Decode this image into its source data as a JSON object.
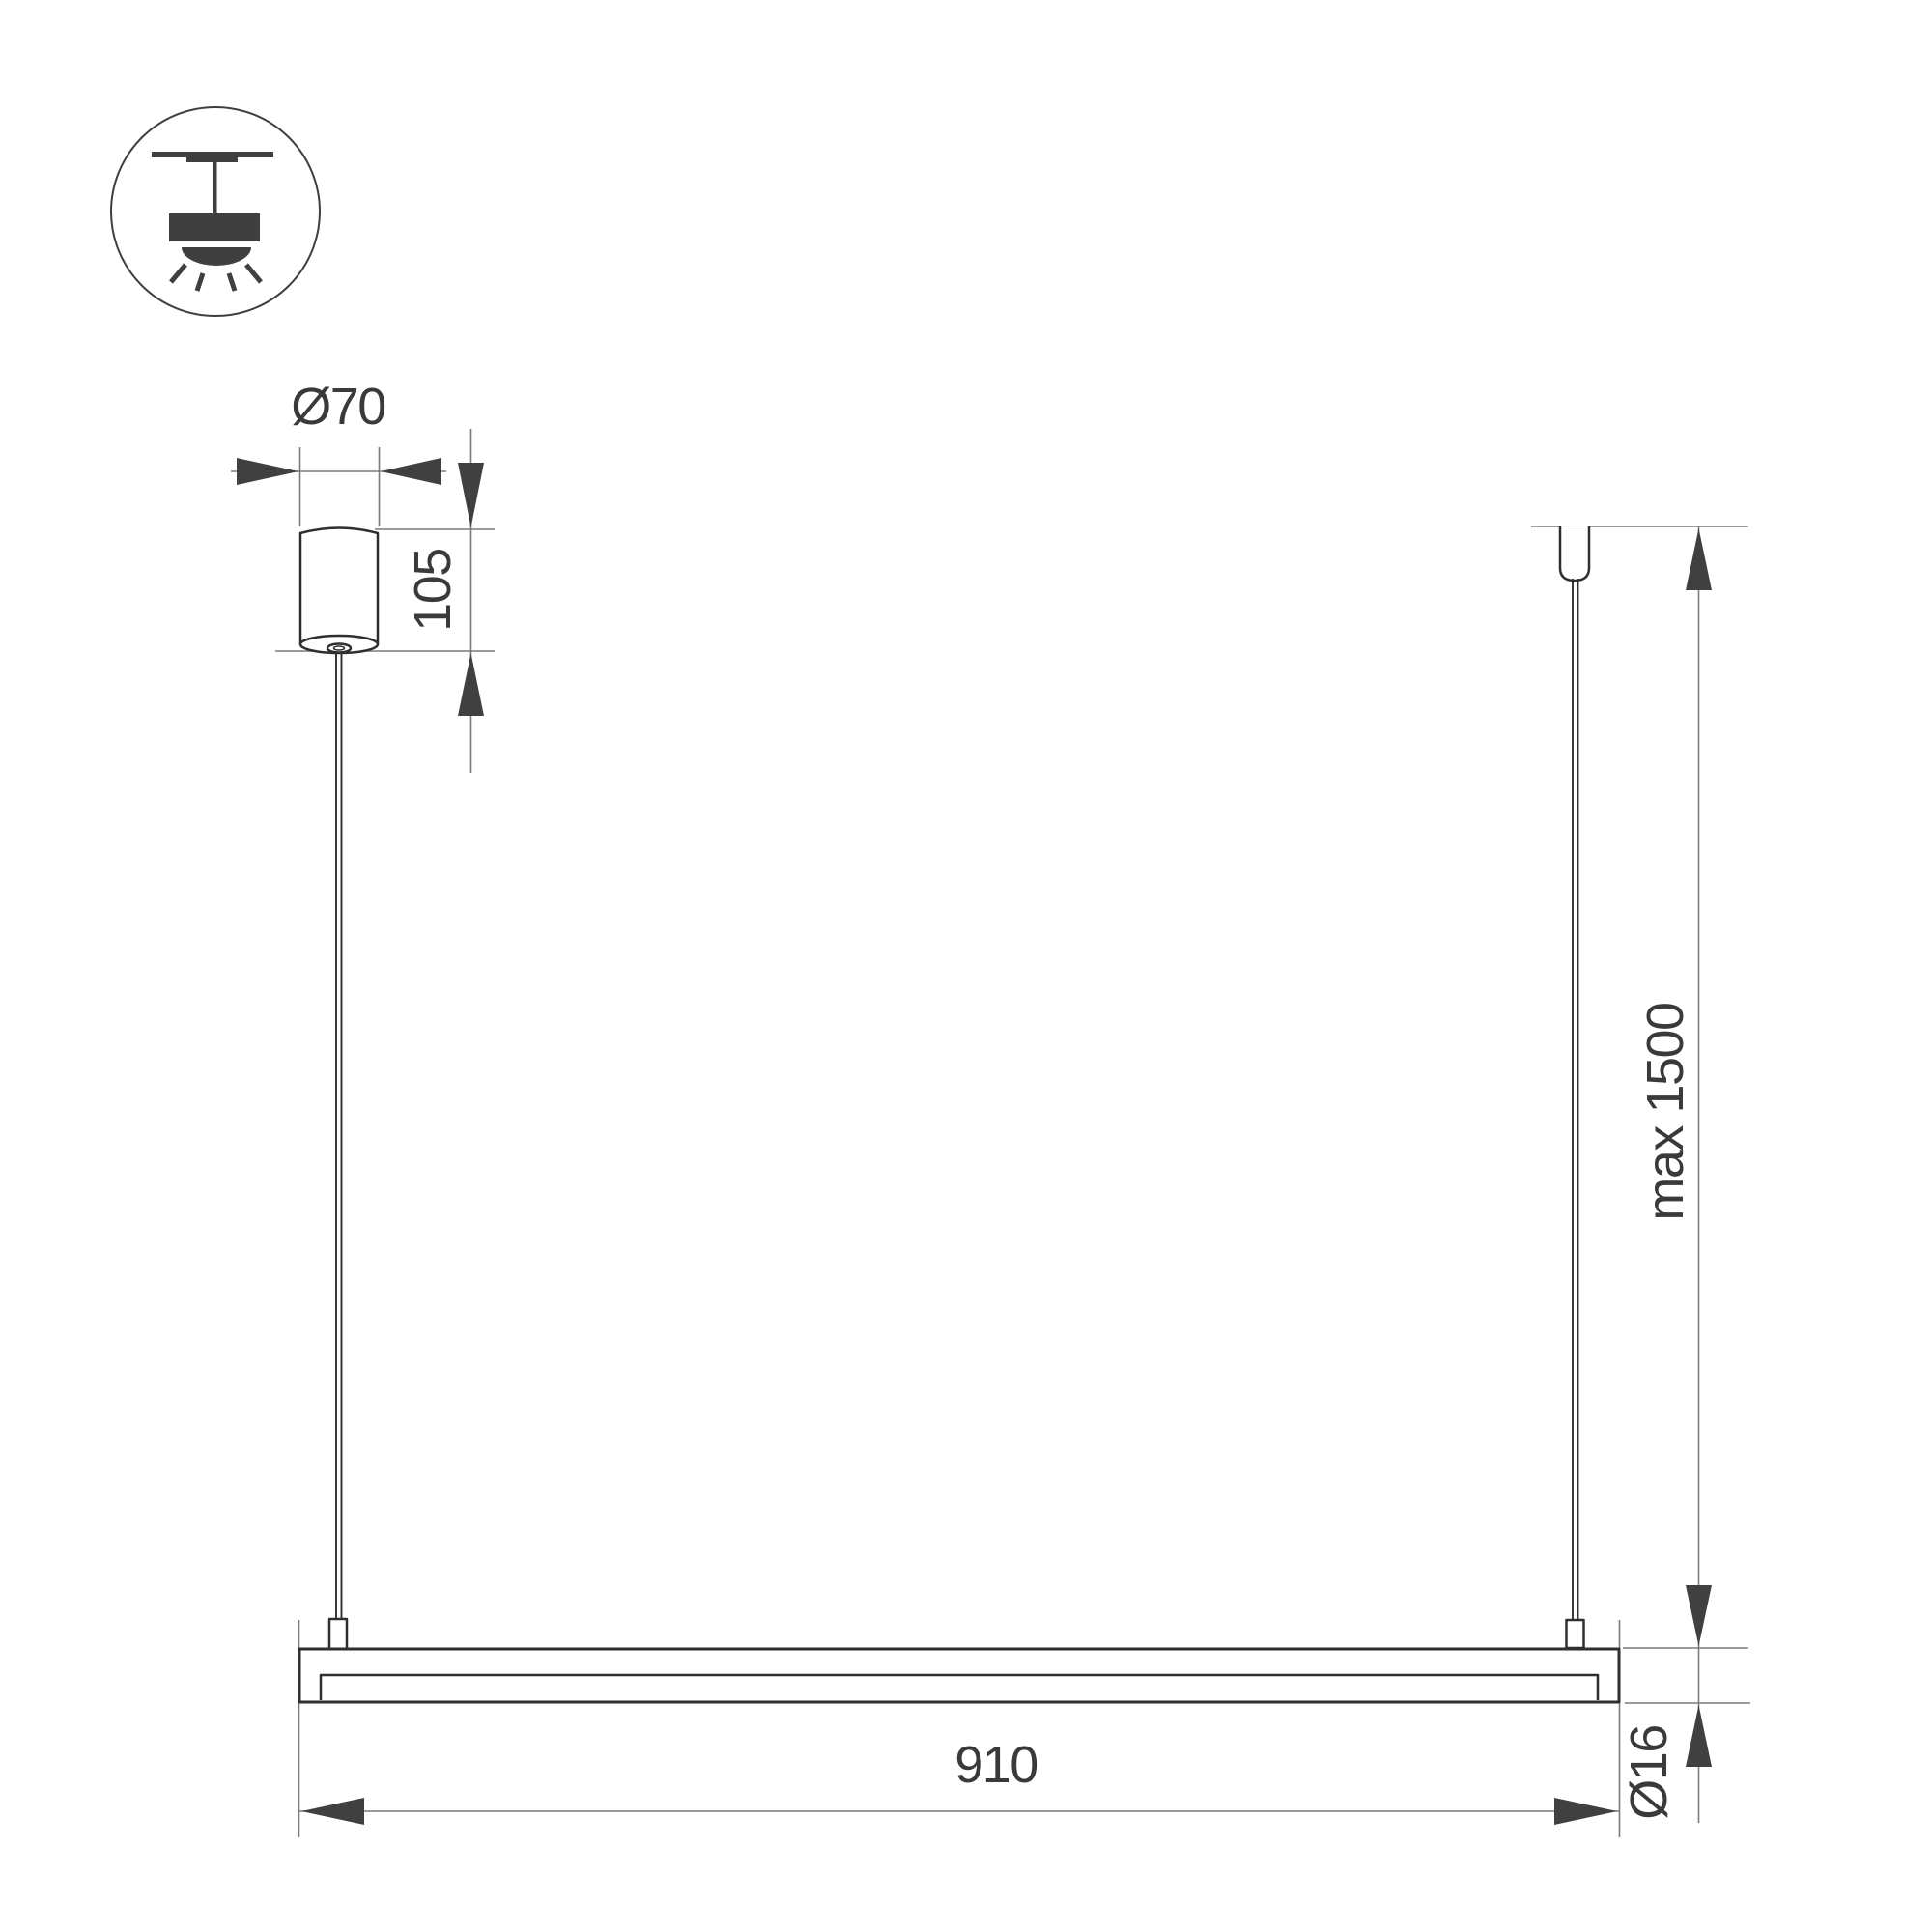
{
  "icon": {
    "name": "ceiling-mount-pendant-icon"
  },
  "dimensions": {
    "canopy_diameter": {
      "label": "Ø70",
      "value": 70
    },
    "canopy_height": {
      "label": "105",
      "value": 105
    },
    "suspension_length": {
      "label": "max 1500",
      "value": 1500
    },
    "bar_length": {
      "label": "910",
      "value": 910
    },
    "tube_diameter": {
      "label": "Ø16",
      "value": 16
    }
  },
  "colors": {
    "outline": "#2f2f2f",
    "dim_line": "#7a7a7a",
    "arrow": "#404040",
    "label": "#3a3a3a",
    "icon": "#3f3f3f",
    "bg": "#ffffff"
  }
}
